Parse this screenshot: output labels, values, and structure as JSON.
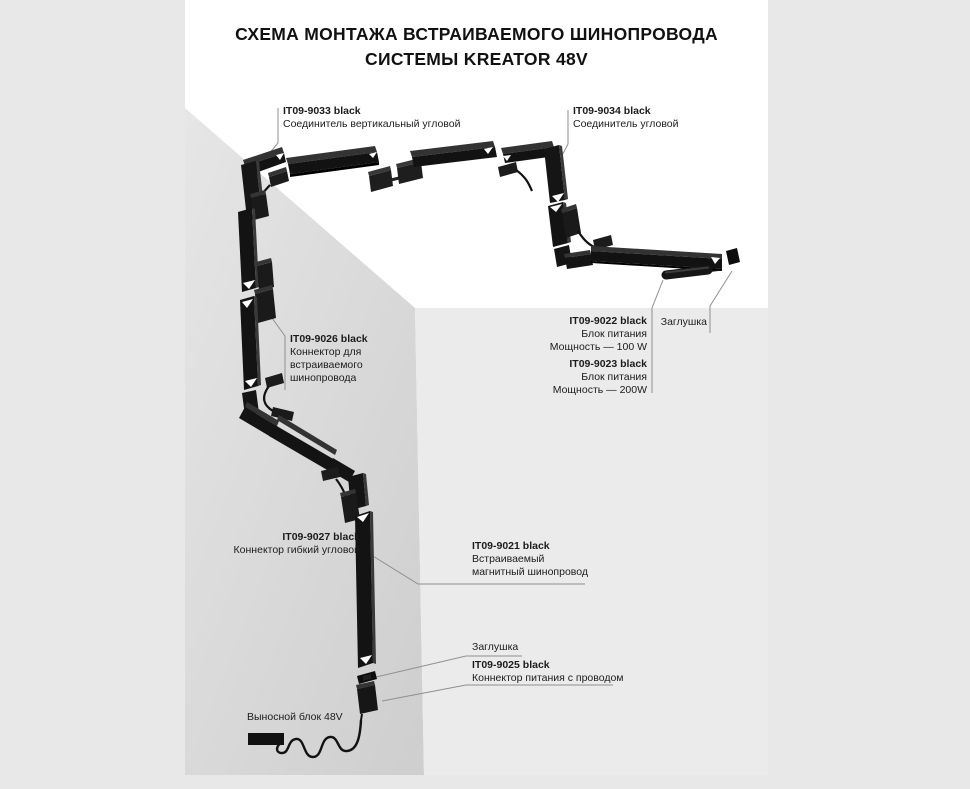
{
  "title": {
    "line1": "СХЕМА МОНТАЖА ВСТРАИВАЕМОГО ШИНОПРОВОДА",
    "line2": "СИСТЕМЫ KREATOR 48V"
  },
  "labels": {
    "it09_9033": {
      "code": "IT09-9033 black",
      "desc": "Соединитель вертикальный угловой"
    },
    "it09_9034": {
      "code": "IT09-9034 black",
      "desc": "Соединитель угловой"
    },
    "it09_9026": {
      "code": "IT09-9026 black",
      "desc1": "Коннектор для",
      "desc2": "встраиваемого",
      "desc3": "шинопровода"
    },
    "it09_9022": {
      "code": "IT09-9022 black",
      "desc1": "Блок питания",
      "desc2": "Мощность — 100 W"
    },
    "it09_9023": {
      "code": "IT09-9023 black",
      "desc1": "Блок питания",
      "desc2": "Мощность — 200W"
    },
    "plug_right": {
      "text": "Заглушка"
    },
    "it09_9027": {
      "code": "IT09-9027 black",
      "desc": "Коннектор гибкий угловой"
    },
    "it09_9021": {
      "code": "IT09-9021 black",
      "desc1": "Встраиваемый",
      "desc2": "магнитный шинопровод"
    },
    "plug_bottom": {
      "text": "Заглушка"
    },
    "it09_9025": {
      "code": "IT09-9025 black",
      "desc": "Коннектор питания с проводом"
    },
    "remote_block": {
      "text": "Выносной блок 48V"
    }
  },
  "colors": {
    "page_bg": "#e8e8e8",
    "ceiling": "#ffffff",
    "wall_left_top": "#e5e5e5",
    "wall_left_bottom": "#cfcfcf",
    "wall_right": "#ebebeb",
    "track": "#121212",
    "track_highlight": "#3a3a3a",
    "leader": "#8f8f8f",
    "text": "#1b1b1b"
  }
}
